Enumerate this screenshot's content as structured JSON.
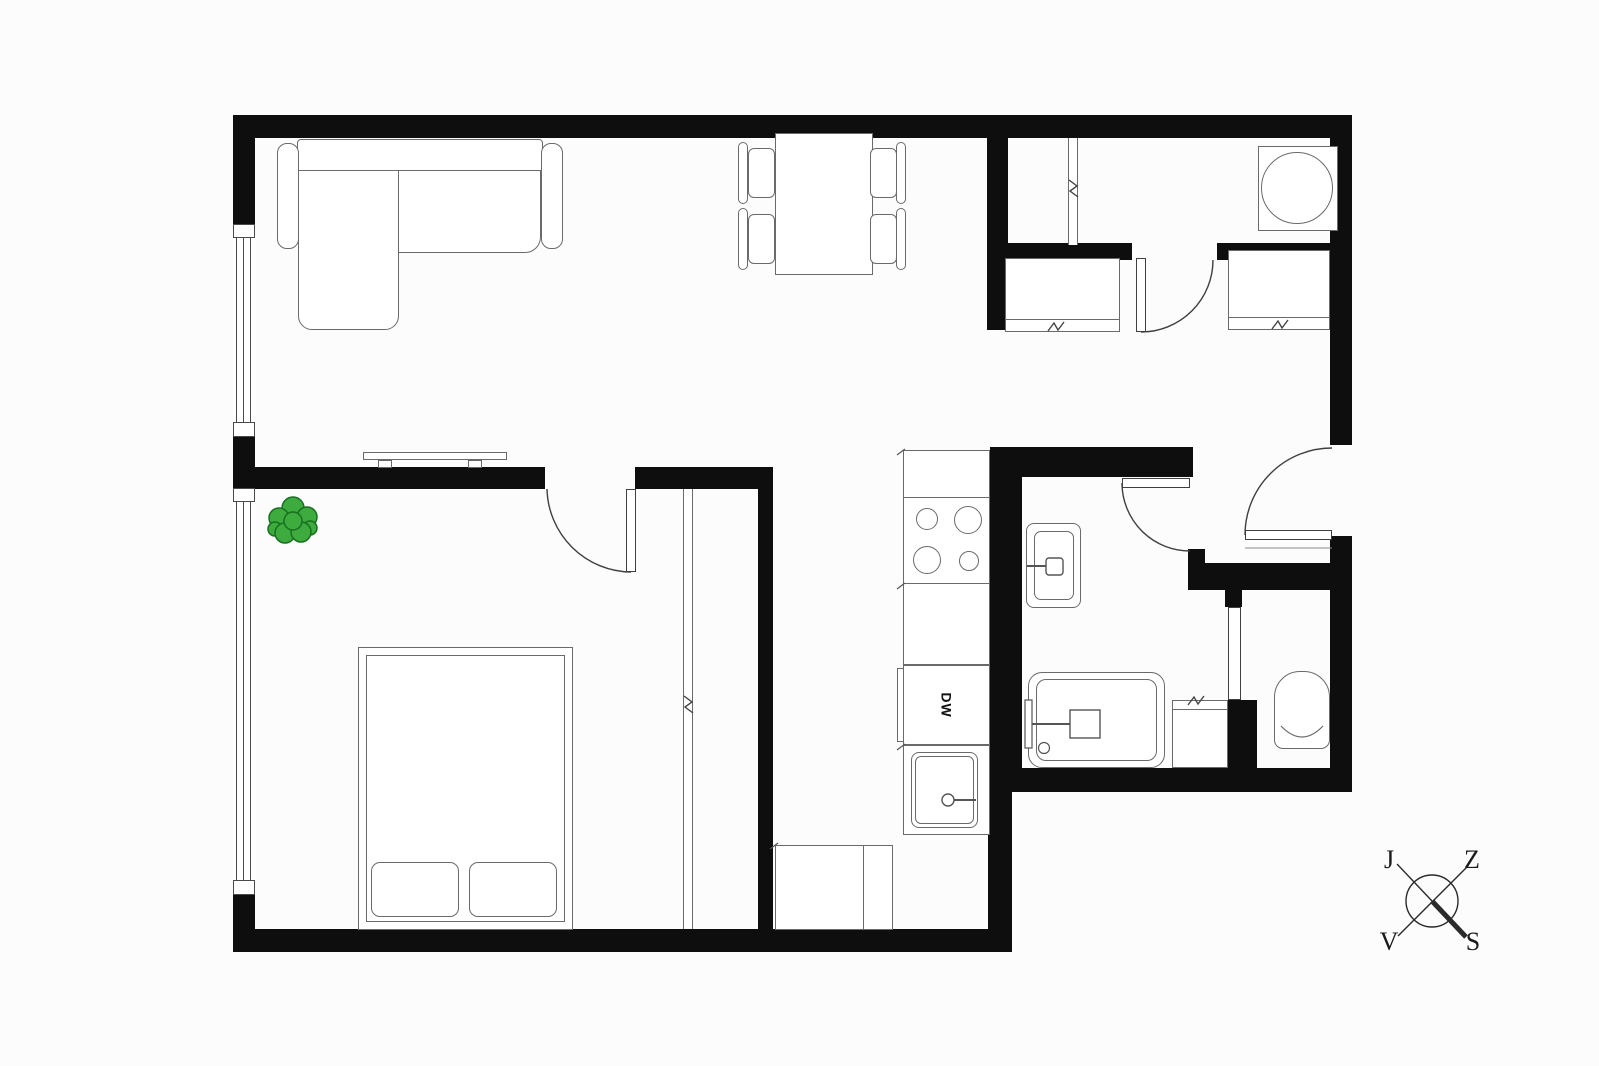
{
  "plan": {
    "type": "apartment floor plan",
    "labels": {
      "dishwasher": "DW"
    },
    "compass": {
      "top_left": "J",
      "top_right": "Z",
      "bottom_left": "V",
      "bottom_right": "S"
    },
    "colors": {
      "wall": "#0e0e0e",
      "furniture_line": "#6a6a6a",
      "door_line": "#3f3f3f",
      "plant_fill": "#3dab3e",
      "plant_stroke": "#17701f",
      "background": "#fcfcfc"
    }
  }
}
